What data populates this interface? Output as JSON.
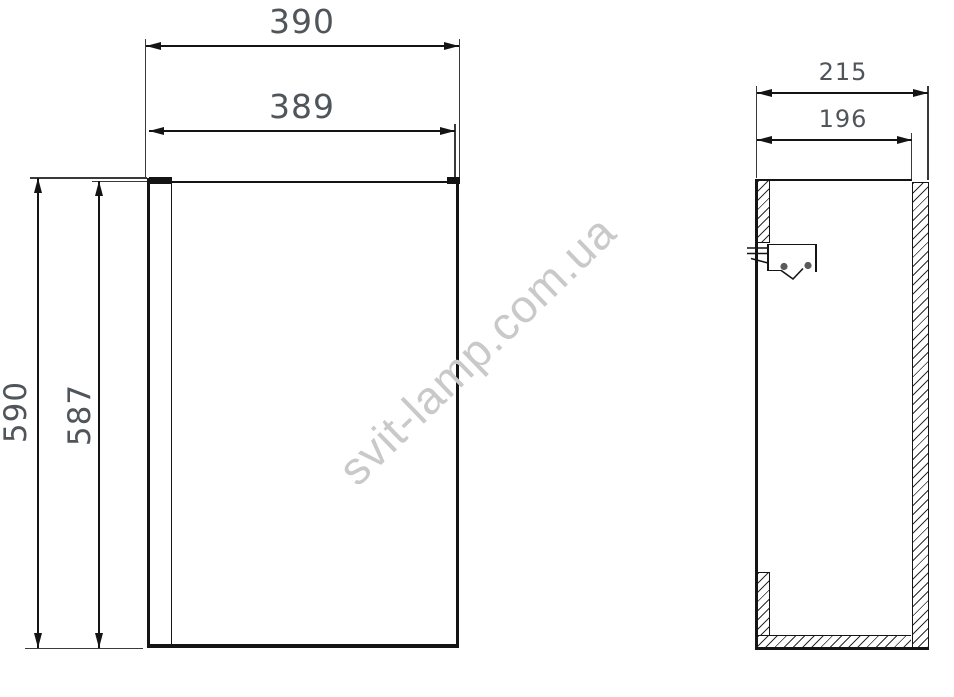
{
  "dimensions": {
    "front_width_outer": "390",
    "front_width_inner": "389",
    "front_height_outer": "590",
    "front_height_inner": "587",
    "side_depth_outer": "215",
    "side_depth_inner": "196"
  },
  "watermark": {
    "text": "svit-lamp.com.ua"
  },
  "colors": {
    "line": "#141414",
    "dimension_text": "#4f555a",
    "watermark": "#c9c9c9",
    "bracket_pins": "#5a5a5a",
    "background": "#ffffff"
  }
}
